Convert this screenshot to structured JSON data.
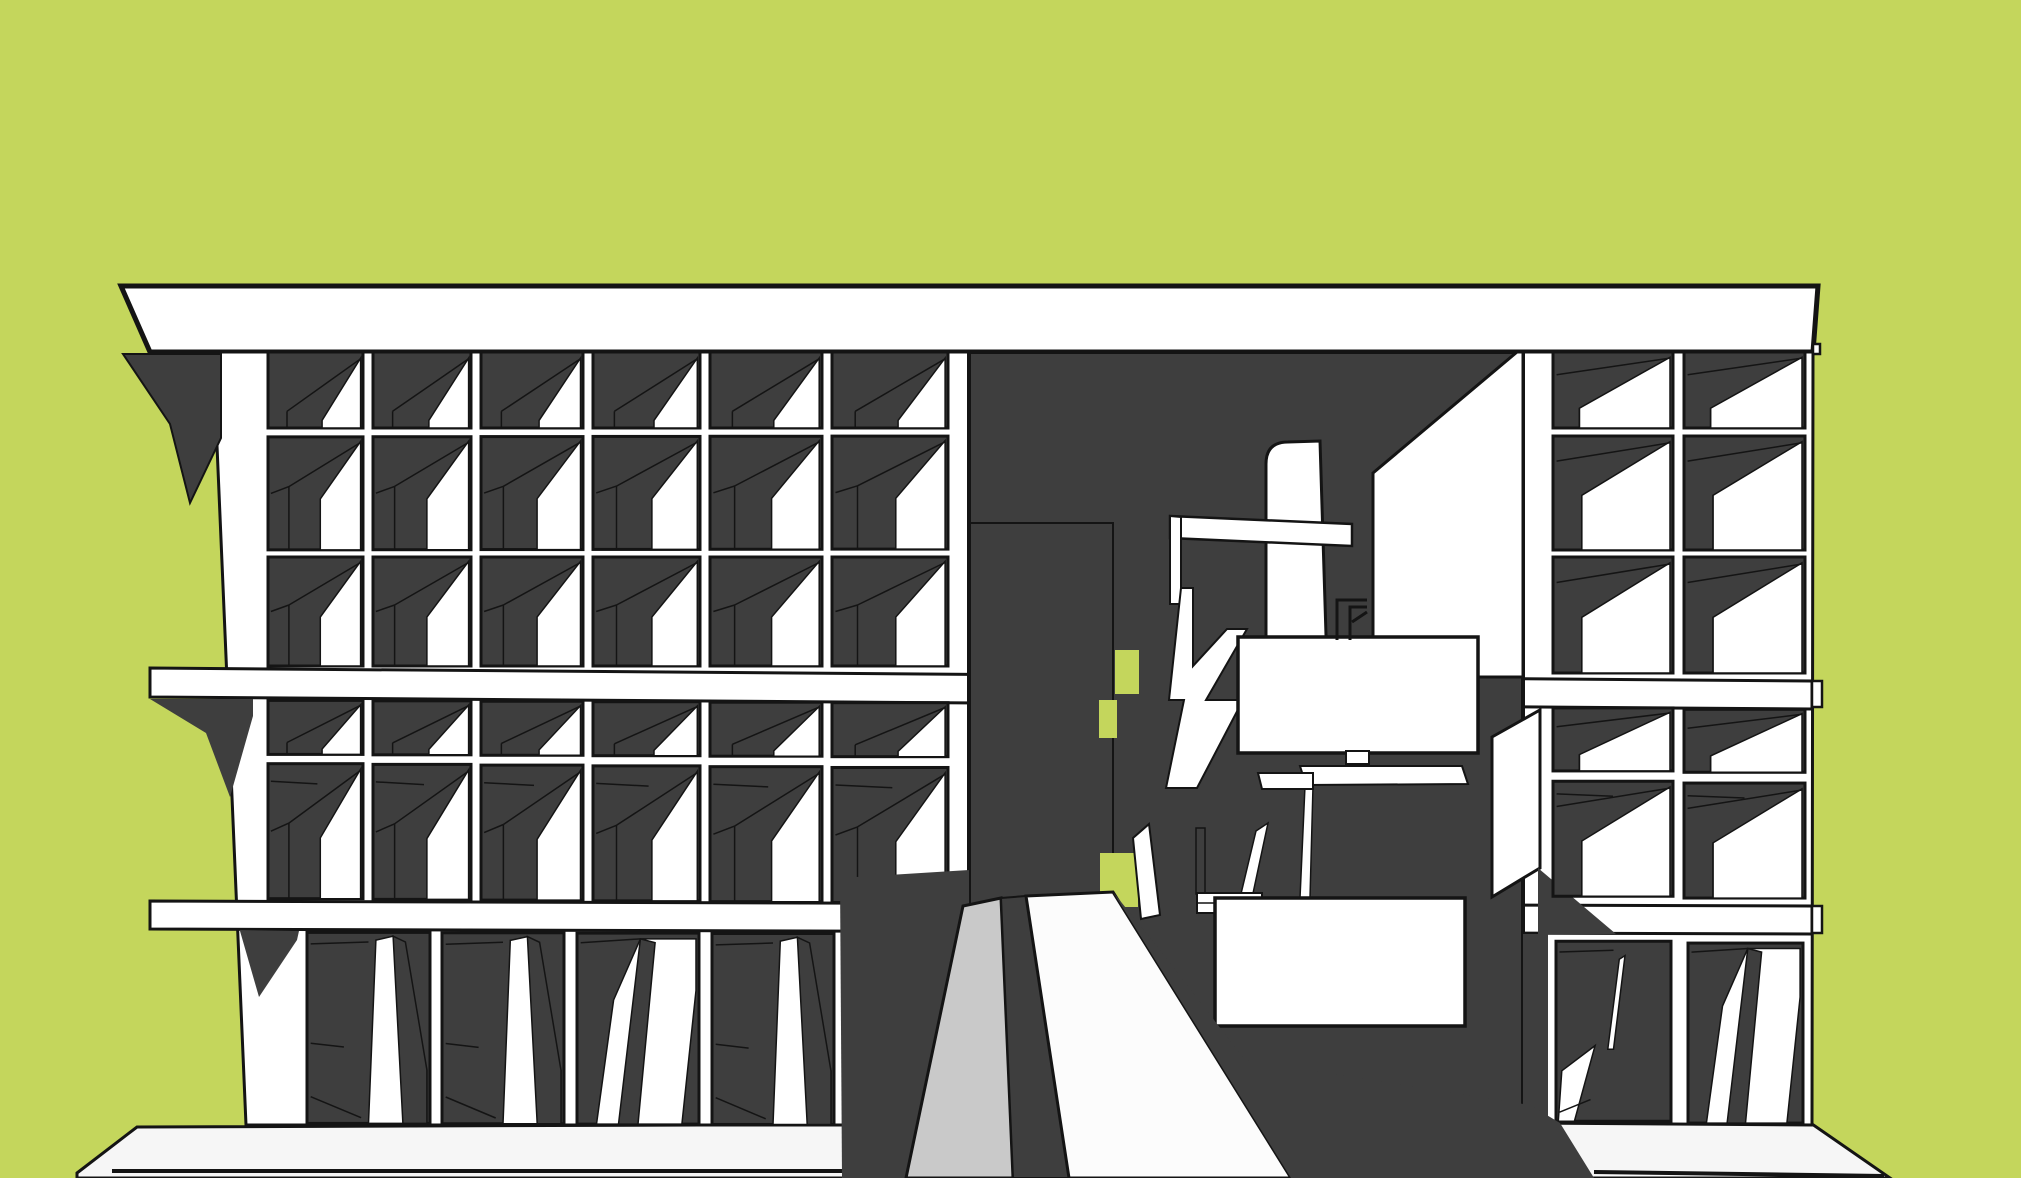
{
  "palette": {
    "background": "#c4d65c",
    "dark": "#3e3e3e",
    "black": "#141414",
    "white": "#ffffff",
    "offwhite": "#f6f6f6",
    "rampwhite": "#fcfcfc",
    "lightgray": "#c9c9c9"
  },
  "scene": {
    "width": 2021,
    "height": 1178,
    "back": [
      {
        "name": "ground-base-slab",
        "kind": "poly",
        "fill": "offwhite",
        "stroke": "black",
        "sw": 3,
        "pts": [
          [
            77,
            1173
          ],
          [
            137,
            1127
          ],
          [
            1520,
            1122
          ],
          [
            1812,
            1124
          ],
          [
            1890,
            1178
          ],
          [
            77,
            1178
          ]
        ]
      },
      {
        "name": "roof-band",
        "kind": "poly",
        "fill": "white",
        "stroke": "black",
        "sw": 5,
        "pts": [
          [
            121,
            286
          ],
          [
            1818,
            286
          ],
          [
            1813,
            352
          ],
          [
            150,
            352
          ]
        ]
      },
      {
        "name": "left-wing-backdrop",
        "kind": "poly",
        "fill": "white",
        "stroke": "black",
        "sw": 3,
        "pts": [
          [
            213,
            352
          ],
          [
            969,
            352
          ],
          [
            969,
            1125
          ],
          [
            246,
            1125
          ]
        ]
      },
      {
        "name": "right-wing-backdrop",
        "kind": "poly",
        "fill": "white",
        "stroke": "black",
        "sw": 3,
        "pts": [
          [
            1523,
            352
          ],
          [
            1813,
            352
          ],
          [
            1812,
            1125
          ],
          [
            1523,
            1123
          ]
        ]
      },
      {
        "name": "floor-band-2",
        "kind": "poly",
        "fill": "white",
        "stroke": "black",
        "sw": 3,
        "pts": [
          [
            150,
            668
          ],
          [
            1812,
            681
          ],
          [
            1812,
            709
          ],
          [
            150,
            697
          ]
        ]
      },
      {
        "name": "floor-band-3",
        "kind": "poly",
        "fill": "white",
        "stroke": "black",
        "sw": 3,
        "pts": [
          [
            150,
            901
          ],
          [
            1812,
            906
          ],
          [
            1812,
            934
          ],
          [
            150,
            929
          ]
        ]
      },
      {
        "name": "slab-tab-band2",
        "kind": "rect",
        "fill": "white",
        "stroke": "black",
        "sw": 2.5,
        "x": 1812,
        "y": 681,
        "w": 10,
        "h": 26
      },
      {
        "name": "slab-tab-band3",
        "kind": "rect",
        "fill": "white",
        "stroke": "black",
        "sw": 2.5,
        "x": 1812,
        "y": 906,
        "w": 10,
        "h": 27
      },
      {
        "name": "slab-tab-roof",
        "kind": "rect",
        "fill": "white",
        "stroke": "black",
        "sw": 2.5,
        "x": 1813,
        "y": 344,
        "w": 7,
        "h": 10
      },
      {
        "name": "shadow-under-roof",
        "kind": "poly",
        "fill": "dark",
        "stroke": "black",
        "sw": 2,
        "pts": [
          [
            123,
            354
          ],
          [
            221,
            354
          ],
          [
            221,
            438
          ],
          [
            190,
            503
          ],
          [
            170,
            424
          ]
        ]
      },
      {
        "name": "shadow-under-band2",
        "kind": "poly",
        "fill": "dark",
        "stroke": "none",
        "sw": 0,
        "pts": [
          [
            150,
            699
          ],
          [
            253,
            699
          ],
          [
            253,
            716
          ],
          [
            230,
            797
          ],
          [
            206,
            733
          ]
        ]
      },
      {
        "name": "shadow-under-band3",
        "kind": "poly",
        "fill": "dark",
        "stroke": "none",
        "sw": 0,
        "pts": [
          [
            240,
            931
          ],
          [
            299,
            931
          ],
          [
            297,
            940
          ],
          [
            259,
            997
          ]
        ]
      },
      {
        "name": "central-opening",
        "kind": "rect",
        "fill": "dark",
        "stroke": "black",
        "sw": 4,
        "x": 969,
        "y": 352,
        "w": 554,
        "h": 771
      },
      {
        "name": "inner-pier-edge",
        "kind": "path",
        "fill": "none",
        "stroke": "black",
        "sw": 2,
        "d": "M969,523 L1113,523 L1113,910"
      },
      {
        "name": "green-gap-upper",
        "kind": "rect",
        "fill": "background",
        "stroke": "none",
        "sw": 0,
        "x": 1115,
        "y": 650,
        "w": 24,
        "h": 44
      },
      {
        "name": "green-gap-mid",
        "kind": "rect",
        "fill": "background",
        "stroke": "none",
        "sw": 0,
        "x": 1099,
        "y": 700,
        "w": 18,
        "h": 38
      },
      {
        "name": "green-gap-lower",
        "kind": "rect",
        "fill": "background",
        "stroke": "none",
        "sw": 0,
        "x": 1100,
        "y": 853,
        "w": 38,
        "h": 54
      },
      {
        "name": "lit-wall-right",
        "kind": "poly",
        "fill": "white",
        "stroke": "black",
        "sw": 3,
        "pts": [
          [
            1373,
            473
          ],
          [
            1517,
            352
          ],
          [
            1523,
            352
          ],
          [
            1523,
            677
          ],
          [
            1373,
            677
          ]
        ]
      },
      {
        "name": "curved-top-panel",
        "kind": "path",
        "fill": "white",
        "stroke": "black",
        "sw": 3,
        "d": "M1266,700 L1266,464 Q1266,442 1288,442 L1320,441 L1328,700 Z"
      },
      {
        "name": "portal-top-bar",
        "kind": "poly",
        "fill": "white",
        "stroke": "black",
        "sw": 2.5,
        "pts": [
          [
            1170,
            516
          ],
          [
            1352,
            524
          ],
          [
            1352,
            546
          ],
          [
            1170,
            538
          ]
        ]
      },
      {
        "name": "portal-post",
        "kind": "poly",
        "fill": "white",
        "stroke": "black",
        "sw": 2,
        "pts": [
          [
            1170,
            516
          ],
          [
            1181,
            517
          ],
          [
            1181,
            604
          ],
          [
            1170,
            604
          ]
        ]
      },
      {
        "name": "stair-zigzag",
        "kind": "poly",
        "fill": "white",
        "stroke": "black",
        "sw": 2,
        "pts": [
          [
            1181,
            588
          ],
          [
            1193,
            588
          ],
          [
            1193,
            666
          ],
          [
            1227,
            629
          ],
          [
            1247,
            629
          ],
          [
            1206,
            700
          ],
          [
            1243,
            700
          ],
          [
            1197,
            788
          ],
          [
            1166,
            788
          ],
          [
            1184,
            700
          ],
          [
            1169,
            700
          ]
        ]
      },
      {
        "name": "white-sliver-1",
        "kind": "poly",
        "fill": "white",
        "stroke": "black",
        "sw": 1.5,
        "pts": [
          [
            1240,
            898
          ],
          [
            1256,
            831
          ],
          [
            1268,
            823
          ],
          [
            1252,
            898
          ]
        ]
      },
      {
        "name": "white-sliver-2",
        "kind": "poly",
        "fill": "white",
        "stroke": "black",
        "sw": 1.5,
        "pts": [
          [
            1300,
            898
          ],
          [
            1305,
            786
          ],
          [
            1313,
            786
          ],
          [
            1310,
            898
          ]
        ]
      },
      {
        "name": "under-box-strip-1",
        "kind": "poly",
        "fill": "white",
        "stroke": "black",
        "sw": 2,
        "pts": [
          [
            1300,
            766
          ],
          [
            1462,
            766
          ],
          [
            1468,
            784
          ],
          [
            1306,
            785
          ]
        ]
      },
      {
        "name": "under-box-strip-2",
        "kind": "poly",
        "fill": "white",
        "stroke": "black",
        "sw": 2,
        "pts": [
          [
            1258,
            773
          ],
          [
            1313,
            773
          ],
          [
            1313,
            789
          ],
          [
            1262,
            789
          ]
        ]
      },
      {
        "name": "balcony-box-upper",
        "kind": "rect",
        "fill": "white",
        "stroke": "black",
        "sw": 3.5,
        "x": 1238,
        "y": 637,
        "w": 240,
        "h": 116
      },
      {
        "name": "balcony-box-upper-tab",
        "kind": "rect",
        "fill": "white",
        "stroke": "black",
        "sw": 2,
        "x": 1346,
        "y": 751,
        "w": 23,
        "h": 13
      },
      {
        "name": "balcony-railing",
        "kind": "path",
        "fill": "none",
        "stroke": "black",
        "sw": 3,
        "d": "M1337,640 L1337,600 L1367,600 M1350,640 L1350,607 L1367,607 M1352,622 L1367,612"
      },
      {
        "name": "leaning-panel",
        "kind": "poly",
        "fill": "white",
        "stroke": "black",
        "sw": 2,
        "pts": [
          [
            1133,
            838
          ],
          [
            1149,
            824
          ],
          [
            1160,
            915
          ],
          [
            1141,
            919
          ]
        ]
      },
      {
        "name": "railing-post",
        "kind": "rect",
        "fill": "dark",
        "stroke": "black",
        "sw": 1.5,
        "x": 1196,
        "y": 828,
        "w": 9,
        "h": 66
      },
      {
        "name": "stair-steps",
        "kind": "rect",
        "fill": "white",
        "stroke": "black",
        "sw": 2,
        "x": 1197,
        "y": 893,
        "w": 65,
        "h": 20
      },
      {
        "name": "stair-steps-line",
        "kind": "path",
        "fill": "none",
        "stroke": "black",
        "sw": 1.5,
        "d": "M1197,903 L1262,903"
      },
      {
        "name": "balcony-box-lower",
        "kind": "rect",
        "fill": "white",
        "stroke": "black",
        "sw": 3.5,
        "x": 1215,
        "y": 898,
        "w": 250,
        "h": 128
      },
      {
        "name": "lit-jamb",
        "kind": "poly",
        "fill": "white",
        "stroke": "black",
        "sw": 3,
        "pts": [
          [
            1492,
            737
          ],
          [
            1540,
            710
          ],
          [
            1540,
            868
          ],
          [
            1492,
            897
          ]
        ]
      },
      {
        "name": "jamb-shadow",
        "kind": "poly",
        "fill": "dark",
        "stroke": "none",
        "sw": 0,
        "pts": [
          [
            1538,
            868
          ],
          [
            1616,
            934
          ],
          [
            1538,
            934
          ]
        ]
      },
      {
        "name": "shadow-pier-strip",
        "kind": "poly",
        "fill": "dark",
        "stroke": "none",
        "sw": 0,
        "pts": [
          [
            1523,
            934
          ],
          [
            1548,
            934
          ],
          [
            1548,
            1123
          ],
          [
            1523,
            1123
          ]
        ]
      }
    ],
    "front": [
      {
        "name": "base-front-line",
        "kind": "path",
        "fill": "none",
        "stroke": "black",
        "sw": 4,
        "d": "M112,1171 L862,1171 M1594,1172 L1884,1176"
      },
      {
        "name": "ground-shadow-left",
        "kind": "poly",
        "fill": "dark",
        "stroke": "none",
        "sw": 0,
        "pts": [
          [
            840,
            878
          ],
          [
            969,
            870
          ],
          [
            969,
            1123
          ],
          [
            908,
            1178
          ],
          [
            842,
            1178
          ]
        ]
      },
      {
        "name": "ramp-side-pylon",
        "kind": "poly",
        "fill": "lightgray",
        "stroke": "black",
        "sw": 3,
        "pts": [
          [
            963,
            906
          ],
          [
            1001,
            898
          ],
          [
            1013,
            1178
          ],
          [
            906,
            1178
          ]
        ]
      },
      {
        "name": "ramp-shadow-strip",
        "kind": "poly",
        "fill": "dark",
        "stroke": "black",
        "sw": 2,
        "pts": [
          [
            1001,
            898
          ],
          [
            1026,
            896
          ],
          [
            1069,
            1178
          ],
          [
            1013,
            1178
          ]
        ]
      },
      {
        "name": "entry-ramp",
        "kind": "poly",
        "fill": "rampwhite",
        "stroke": "black",
        "sw": 3,
        "pts": [
          [
            1026,
            896
          ],
          [
            1113,
            892
          ],
          [
            1291,
            1178
          ],
          [
            1069,
            1178
          ]
        ]
      },
      {
        "name": "ground-shadow-right",
        "kind": "poly",
        "fill": "dark",
        "stroke": "none",
        "sw": 0,
        "pts": [
          [
            1113,
            892
          ],
          [
            1160,
            950
          ],
          [
            1245,
            1060
          ],
          [
            1530,
            1105
          ],
          [
            1560,
            1123
          ],
          [
            1594,
            1178
          ],
          [
            1291,
            1178
          ]
        ]
      }
    ],
    "wings": {
      "left": {
        "name": "left-facade-grid",
        "clip": [
          [
            213,
            352
          ],
          [
            969,
            352
          ],
          [
            969,
            1125
          ],
          [
            246,
            1125
          ]
        ],
        "cols_upper": [
          [
            268,
            95
          ],
          [
            373,
            98
          ],
          [
            481,
            102
          ],
          [
            593,
            107
          ],
          [
            710,
            112
          ],
          [
            832,
            116
          ]
        ],
        "cols_ground": [
          [
            307,
            123
          ],
          [
            442,
            122
          ],
          [
            577,
            122
          ],
          [
            712,
            122
          ],
          [
            847,
            116
          ]
        ],
        "x0": 213,
        "x1": 969,
        "rows": [
          {
            "yl": 352,
            "yr": 352,
            "h": 76,
            "cols": "upper",
            "type": "short"
          },
          {
            "yl": 437,
            "yr": 436,
            "h": 113,
            "cols": "upper",
            "type": "tall"
          },
          {
            "yl": 557,
            "yr": 557,
            "h": 109,
            "cols": "upper",
            "type": "tall"
          },
          {
            "yl": 700,
            "yr": 703,
            "h": 54,
            "cols": "upper",
            "type": "short"
          },
          {
            "yl": 763,
            "yr": 768,
            "h": 135,
            "cols": "upper",
            "type": "tall2"
          },
          {
            "yl": 932,
            "yr": 934,
            "h": 191,
            "cols": "ground",
            "types": [
              "doorA",
              "doorA",
              "doorB",
              "doorA",
              "doorD"
            ]
          }
        ]
      },
      "right": {
        "name": "right-facade-grid",
        "clip": [
          [
            1523,
            352
          ],
          [
            1813,
            352
          ],
          [
            1812,
            1125
          ],
          [
            1523,
            1123
          ]
        ],
        "cols_upper": [
          [
            1553,
            120
          ],
          [
            1684,
            121
          ]
        ],
        "cols_ground": [
          [
            1556,
            115
          ],
          [
            1688,
            115
          ]
        ],
        "x0": 1523,
        "x1": 1813,
        "rows": [
          {
            "yl": 352,
            "yr": 352,
            "h": 76,
            "cols": "upper",
            "type": "shortR"
          },
          {
            "yl": 436,
            "yr": 436,
            "h": 114,
            "cols": "upper",
            "type": "tallR"
          },
          {
            "yl": 557,
            "yr": 557,
            "h": 116,
            "cols": "upper",
            "type": "tallR"
          },
          {
            "yl": 707,
            "yr": 710,
            "h": 63,
            "cols": "upper",
            "type": "shortR"
          },
          {
            "yl": 780,
            "yr": 784,
            "h": 115,
            "cols": "upper",
            "type": "tall2R"
          },
          {
            "yl": 940,
            "yr": 944,
            "h": 180,
            "cols": "ground",
            "types": [
              "doorC",
              "doorB"
            ]
          }
        ]
      }
    }
  }
}
